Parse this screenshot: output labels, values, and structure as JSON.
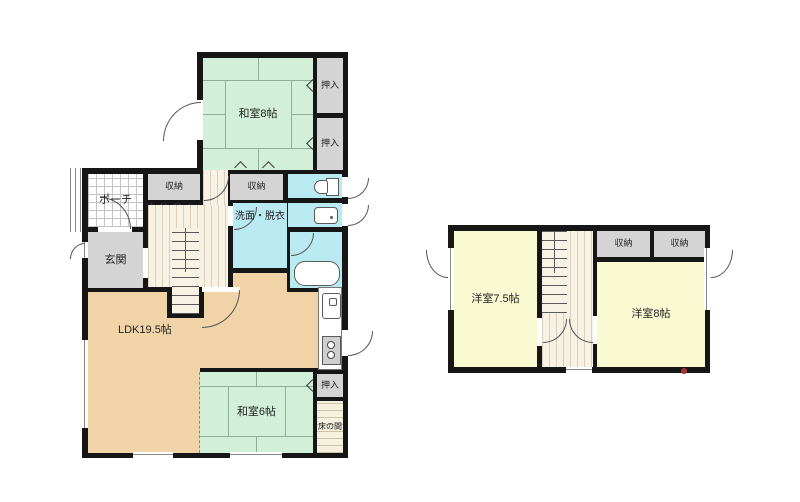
{
  "colors": {
    "wall": "#161616",
    "line": "#555555",
    "tatami_green": "#d2efda",
    "tatami_line": "#8fae96",
    "ldk_tan": "#f0d3a7",
    "water_blue": "#b9eaf2",
    "room_yellow": "#fafad2",
    "storage_gray": "#d4d4d4",
    "hall_cream": "#f7f2e3",
    "hall_stripe": "#d9cfba",
    "red_dot": "#a83232"
  },
  "floor1": {
    "washitsu8": "和室8帖",
    "oshiire_a": "押入",
    "oshiire_b": "押入",
    "shuno_left": "収納",
    "shuno_mid": "収納",
    "porch": "ポーチ",
    "genkan": "玄関",
    "senmen": "洗面・脱衣",
    "ldk": "LDK19.5帖",
    "washitsu6": "和室6帖",
    "oshiire_c": "押入",
    "tokonoma": "床の間"
  },
  "floor2": {
    "yoshitsu75": "洋室7.5帖",
    "shuno_a": "収納",
    "shuno_b": "収納",
    "yoshitsu8": "洋室8帖"
  },
  "icons": {
    "toilet": "toilet-icon",
    "washbasin": "washbasin-icon",
    "bathtub": "bathtub-icon",
    "kitchen_sink": "sink-icon",
    "stove": "stove-icon"
  }
}
